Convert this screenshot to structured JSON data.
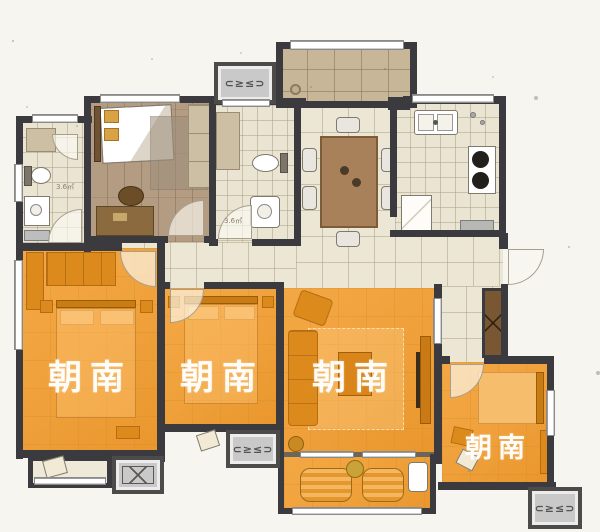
{
  "meta": {
    "type": "apartment-floor-plan"
  },
  "labels": {
    "south_bedroom_1": "朝南",
    "south_bedroom_2": "朝南",
    "south_living": "朝南",
    "south_bedroom_3": "朝南"
  },
  "area_labels": {
    "bathroom_1": "3.6㎡",
    "bathroom_2": "3.6㎡"
  },
  "ac_unit_mark": "⊂≥≤⊃",
  "colors": {
    "background": "#f6f5f0",
    "wall": "#3b3a3e",
    "south_facing_fill": "#f0a03c",
    "tile_floor": "#ece6d5",
    "terrace_floor": "#c8b698",
    "wood_floor": "#b7a187",
    "ac_platform": "#c9c9c9"
  }
}
